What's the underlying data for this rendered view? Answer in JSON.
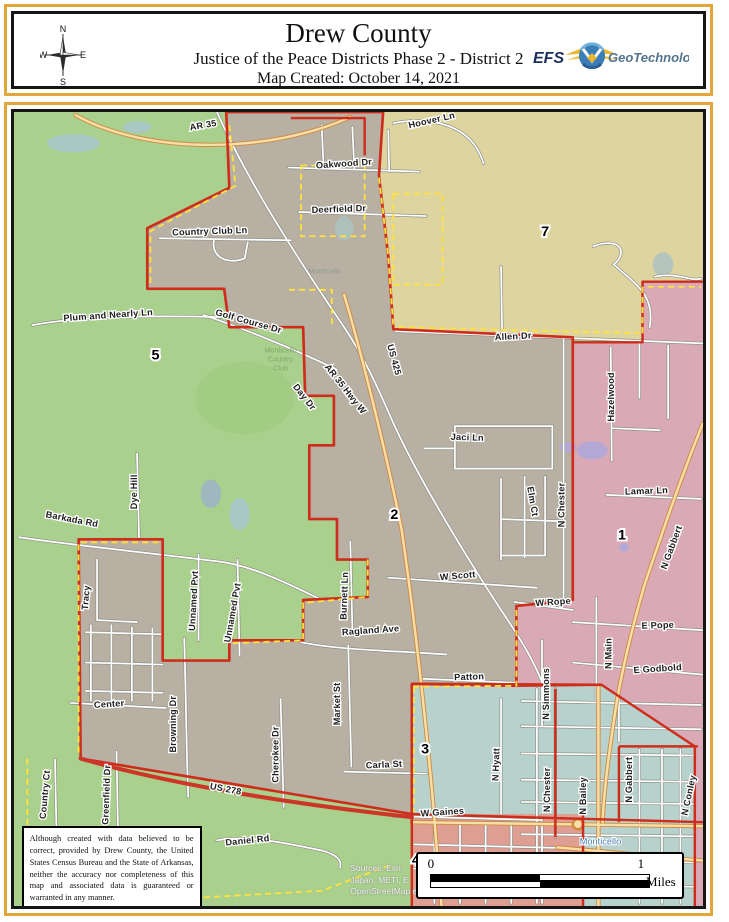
{
  "header": {
    "title": "Drew County",
    "subtitle": "Justice of the Peace Districts Phase 2 - District 2",
    "created": "Map Created: October 14, 2021",
    "compass": {
      "n": "N",
      "e": "E",
      "s": "S",
      "w": "W"
    },
    "logo": {
      "efs": "EFS",
      "geo": "GeoTechnologies"
    }
  },
  "map": {
    "colors": {
      "district5_green": "#a9d08c",
      "district2_gray": "#b7b0a3",
      "district7_khaki": "#ddd49f",
      "district1_pink": "#d9a9b6",
      "district3_teal": "#b7d2cd",
      "district4_salmon": "#de9e92",
      "boundary_red": "#cf2d1c",
      "city_limit_yellow": "#ffe23c",
      "highway_cream": "#f6dfa8",
      "highway_casing": "#d08a3e",
      "us278_red": "#cd3527",
      "water_purple": "#b3a8d6",
      "water_teal": "#a8c9c3"
    },
    "district_labels": [
      {
        "text": "5",
        "x": 168,
        "y": 362
      },
      {
        "text": "7",
        "x": 548,
        "y": 240
      },
      {
        "text": "2",
        "x": 401,
        "y": 520
      },
      {
        "text": "1",
        "x": 623,
        "y": 540
      },
      {
        "text": "3",
        "x": 431,
        "y": 752
      },
      {
        "text": "4",
        "x": 422,
        "y": 862
      }
    ],
    "road_labels": [
      {
        "text": "AR 35",
        "x": 215,
        "y": 133,
        "rot": -10
      },
      {
        "text": "Hoover Ln",
        "x": 438,
        "y": 128,
        "rot": -13
      },
      {
        "text": "Oakwood Dr",
        "x": 352,
        "y": 171,
        "rot": -4
      },
      {
        "text": "Deerfield Dr",
        "x": 347,
        "y": 216,
        "rot": -2
      },
      {
        "text": "Country Club Ln",
        "x": 221,
        "y": 238,
        "rot": -2
      },
      {
        "text": "Plum and Nearly Ln",
        "x": 122,
        "y": 321,
        "rot": -4
      },
      {
        "text": "Golf Course Dr",
        "x": 258,
        "y": 327,
        "rot": 16
      },
      {
        "text": "Allen Dr",
        "x": 517,
        "y": 342,
        "rot": -3
      },
      {
        "text": "US 425",
        "x": 398,
        "y": 363,
        "rot": 75
      },
      {
        "text": "AR 35 Hwy W",
        "x": 351,
        "y": 393,
        "rot": 52
      },
      {
        "text": "Day Dr",
        "x": 311,
        "y": 401,
        "rot": 52
      },
      {
        "text": "Jaci Ln",
        "x": 472,
        "y": 442,
        "rot": 2
      },
      {
        "text": "Elm Ct",
        "x": 533,
        "y": 503,
        "rot": 80
      },
      {
        "text": "N Chester",
        "x": 567,
        "y": 506,
        "rot": -90
      },
      {
        "text": "Hazelwood",
        "x": 615,
        "y": 399,
        "rot": -90
      },
      {
        "text": "Lamar Ln",
        "x": 647,
        "y": 495,
        "rot": -2
      },
      {
        "text": "N Gabbert",
        "x": 674,
        "y": 549,
        "rot": -70
      },
      {
        "text": "Barkada Rd",
        "x": 86,
        "y": 523,
        "rot": 11
      },
      {
        "text": "Dye Hill",
        "x": 150,
        "y": 493,
        "rot": -90
      },
      {
        "text": "Tracy",
        "x": 103,
        "y": 598,
        "rot": -85
      },
      {
        "text": "Unnamed Pvt",
        "x": 208,
        "y": 601,
        "rot": -87
      },
      {
        "text": "Unnamed Pvt",
        "x": 246,
        "y": 613,
        "rot": -80
      },
      {
        "text": "Burnett Ln",
        "x": 355,
        "y": 596,
        "rot": -88
      },
      {
        "text": "W Scott",
        "x": 463,
        "y": 579,
        "rot": -5
      },
      {
        "text": "Ragland Ave",
        "x": 378,
        "y": 633,
        "rot": -4
      },
      {
        "text": "W Rope",
        "x": 556,
        "y": 605,
        "rot": -4
      },
      {
        "text": "E Pope",
        "x": 658,
        "y": 628,
        "rot": -2
      },
      {
        "text": "N Simmons",
        "x": 552,
        "y": 693,
        "rot": -90
      },
      {
        "text": "N Main",
        "x": 613,
        "y": 653,
        "rot": -90
      },
      {
        "text": "E Godbold",
        "x": 658,
        "y": 671,
        "rot": -4
      },
      {
        "text": "Patton",
        "x": 474,
        "y": 679,
        "rot": -2
      },
      {
        "text": "Market St",
        "x": 348,
        "y": 703,
        "rot": -90
      },
      {
        "text": "Browning Dr",
        "x": 188,
        "y": 723,
        "rot": -90
      },
      {
        "text": "Cherokee Dr",
        "x": 288,
        "y": 753,
        "rot": -90
      },
      {
        "text": "N Hyatt",
        "x": 503,
        "y": 763,
        "rot": -88
      },
      {
        "text": "Carla St",
        "x": 391,
        "y": 766,
        "rot": -3
      },
      {
        "text": "Center",
        "x": 123,
        "y": 706,
        "rot": -4
      },
      {
        "text": "Greenfield Dr",
        "x": 123,
        "y": 793,
        "rot": -88
      },
      {
        "text": "Country Ct",
        "x": 63,
        "y": 793,
        "rot": -85
      },
      {
        "text": "US 278",
        "x": 236,
        "y": 790,
        "rot": 11
      },
      {
        "text": "W Gaines",
        "x": 448,
        "y": 813,
        "rot": -4
      },
      {
        "text": "Daniel Rd",
        "x": 258,
        "y": 841,
        "rot": -6
      },
      {
        "text": "N Chester",
        "x": 553,
        "y": 788,
        "rot": -90
      },
      {
        "text": "N Bailey",
        "x": 588,
        "y": 794,
        "rot": -90
      },
      {
        "text": "N Gabbert",
        "x": 633,
        "y": 778,
        "rot": -90
      },
      {
        "text": "N Conley",
        "x": 691,
        "y": 794,
        "rot": -78
      }
    ],
    "place_labels": [
      {
        "text": "Monticello",
        "x": 333,
        "y": 277,
        "kind": "faint"
      },
      {
        "text": "Monticello",
        "x": 290,
        "y": 355,
        "kind": "green"
      },
      {
        "text": "Country",
        "x": 290,
        "y": 364,
        "kind": "green"
      },
      {
        "text": "Club",
        "x": 290,
        "y": 373,
        "kind": "green"
      },
      {
        "text": "Monticello",
        "x": 602,
        "y": 842,
        "kind": "blue"
      }
    ],
    "disclaimer": "Although created with data believed to be correct, provided by Drew County, the United States Census Bureau and the State of Arkansas, neither the accuracy nor completeness of this map and associated data is guaranteed or warranted in any manner.",
    "sources": [
      "Sources: Esri,",
      "Japan, METI, E",
      "OpenStreetMap contributors, and the GIS User Community"
    ],
    "scalebar": {
      "zero": "0",
      "one": "1",
      "unit": "Miles"
    }
  }
}
